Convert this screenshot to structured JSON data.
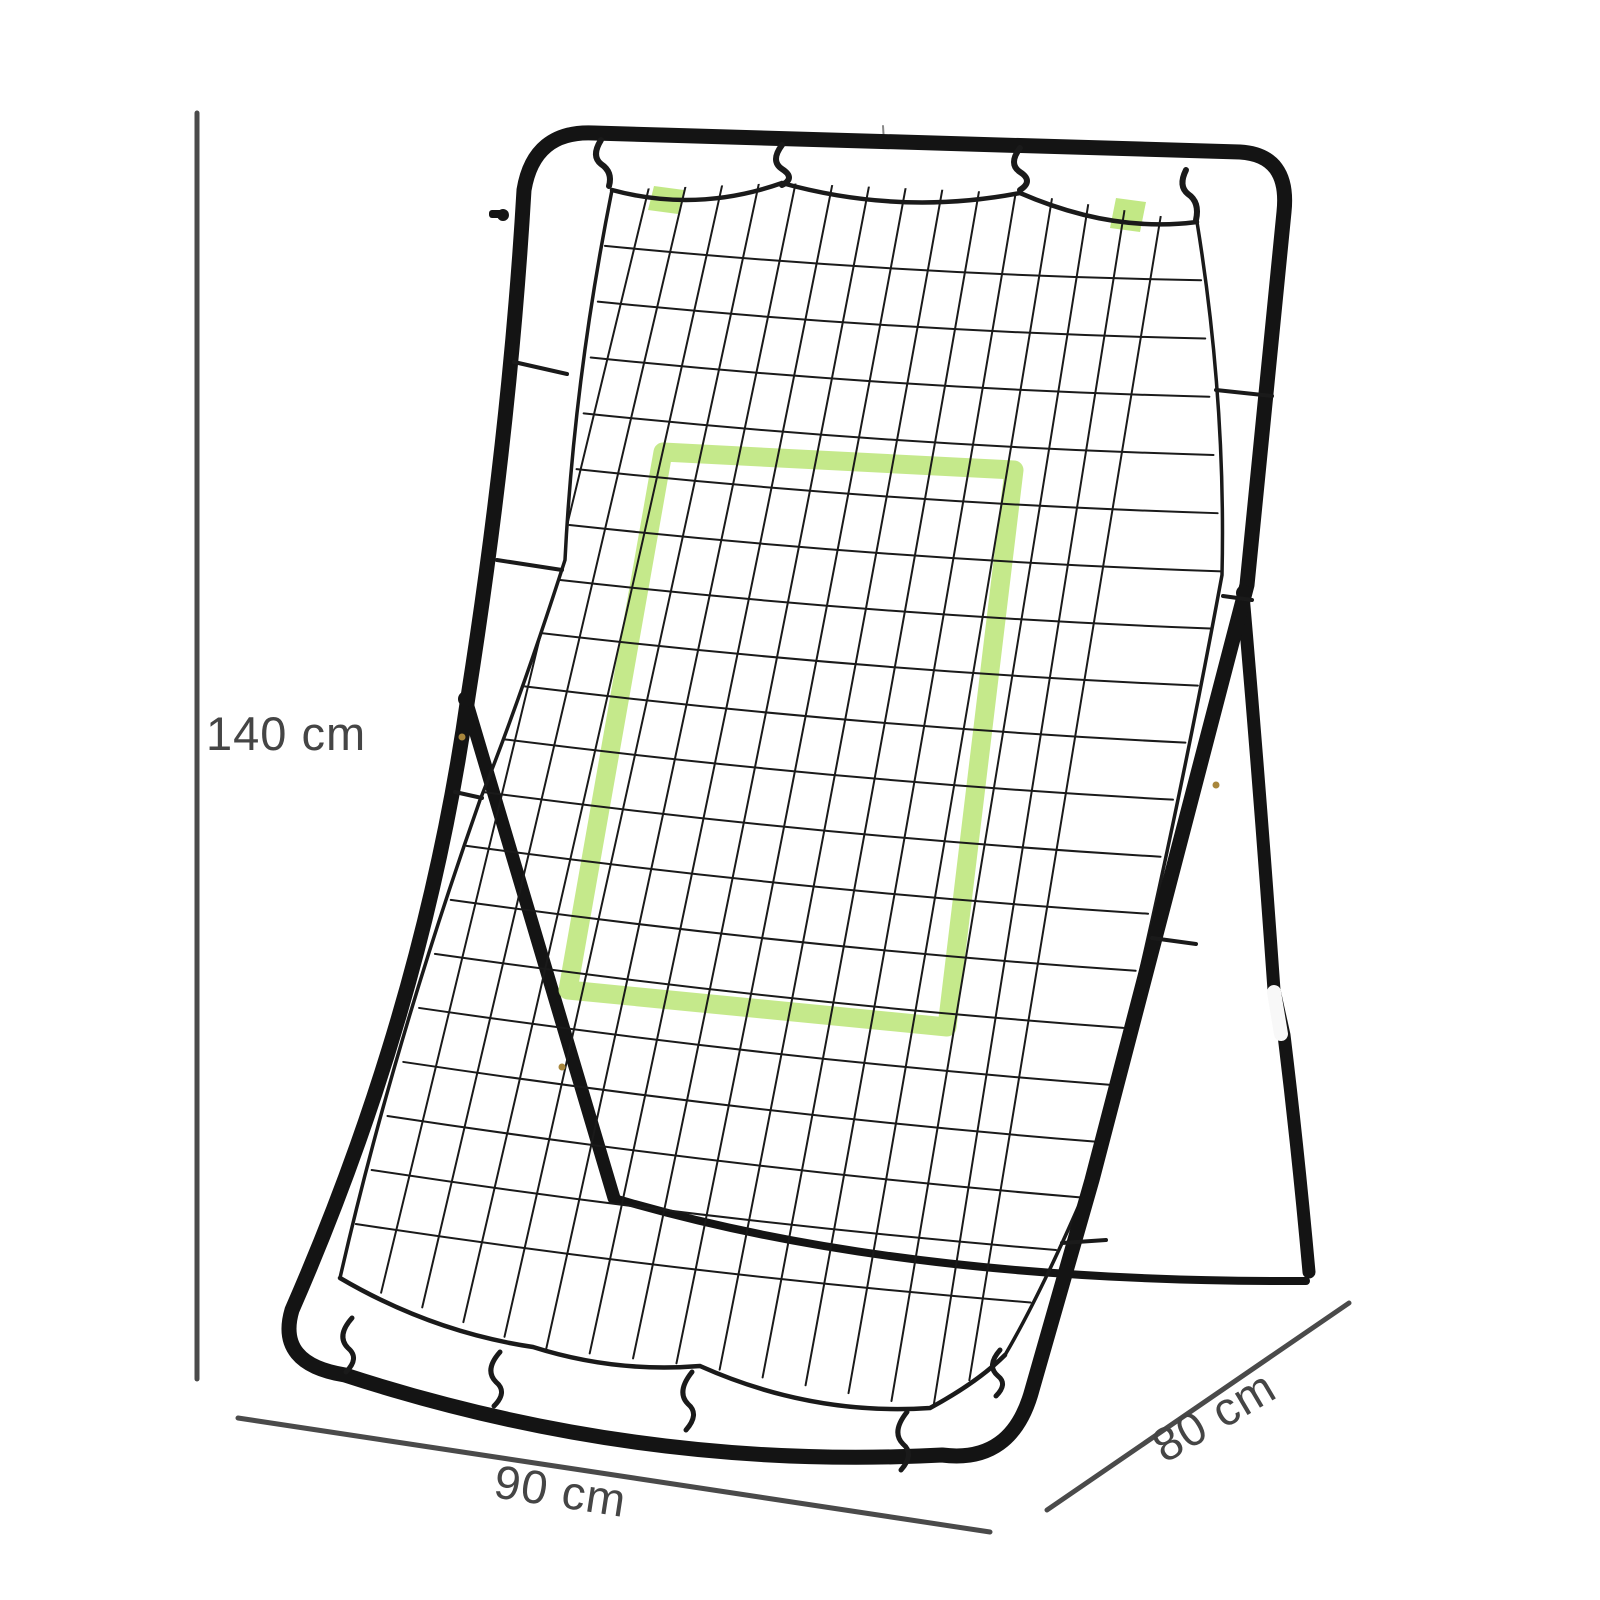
{
  "product": {
    "name": "rebounder-net-with-target-zone",
    "description": "Black tubular steel pitch-back rebounder with black bungee-corded mesh net and lime green target rectangle, shown on white background with dimension annotations"
  },
  "dimensions": {
    "height_label": "140 cm",
    "width_label": "90 cm",
    "depth_label": "80 cm"
  },
  "colors": {
    "background": "#ffffff",
    "frame": "#141414",
    "net": "#1a1a1a",
    "target_green": "#bfe77e",
    "dimension_line": "#4a4a4a",
    "dimension_text": "#454545",
    "collar_white": "#f8f8f8",
    "rivet_gold": "#a8863c"
  }
}
